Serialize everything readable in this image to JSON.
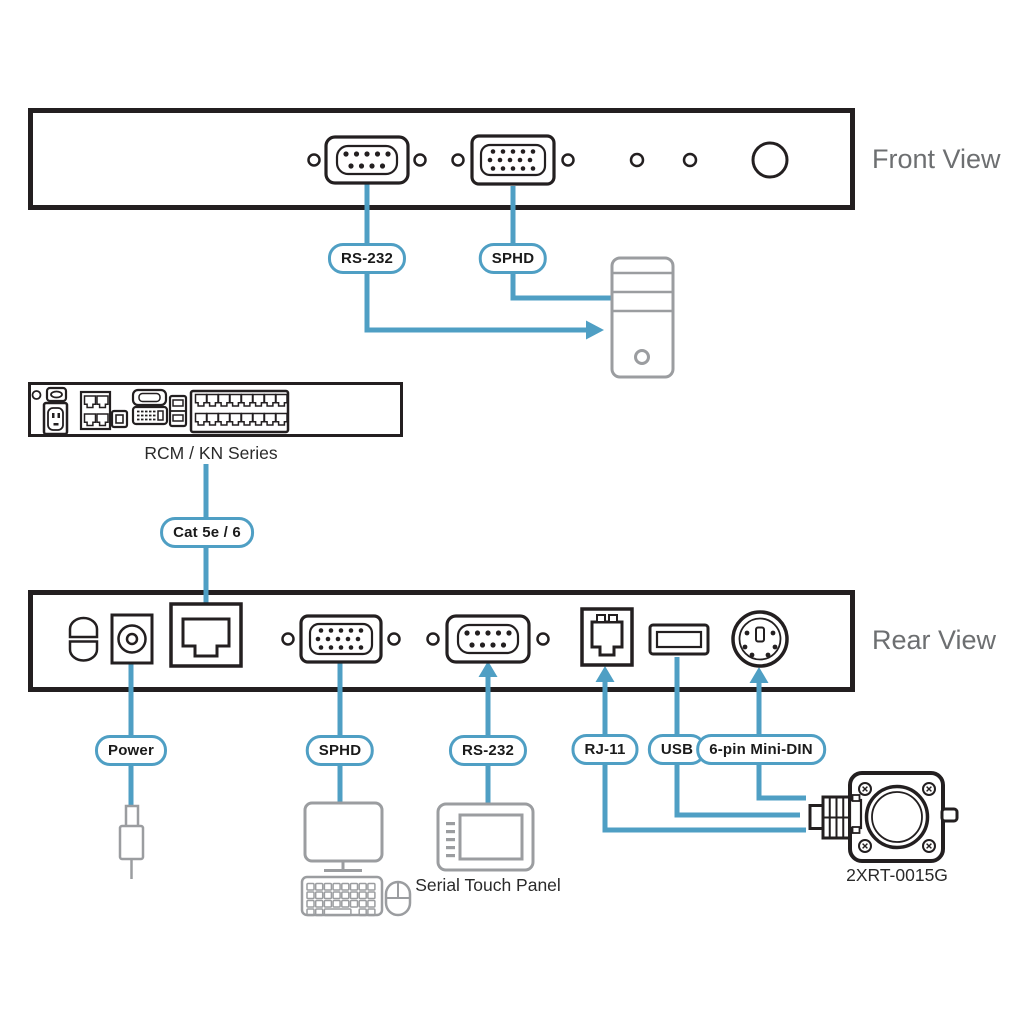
{
  "front_view": {
    "caption": "Front View",
    "pills": {
      "rs232": "RS-232",
      "sphd": "SPHD"
    }
  },
  "kvm_switch": {
    "caption": "RCM / KN Series"
  },
  "cable": {
    "label": "Cat 5e / 6"
  },
  "rear_view": {
    "caption": "Rear View",
    "pills": {
      "power": "Power",
      "sphd": "SPHD",
      "rs232": "RS-232",
      "rj11": "RJ-11",
      "usb": "USB",
      "mini_din": "6-pin Mini-DIN"
    }
  },
  "peripherals": {
    "touch_panel_caption": "Serial Touch Panel",
    "audio_device_caption": "2XRT-0015G"
  },
  "colors": {
    "connector_line": "#4f9fc4",
    "outline": "#231f20",
    "peripheral_gray": "#9b9da0",
    "caption_gray": "#6d6f71"
  }
}
